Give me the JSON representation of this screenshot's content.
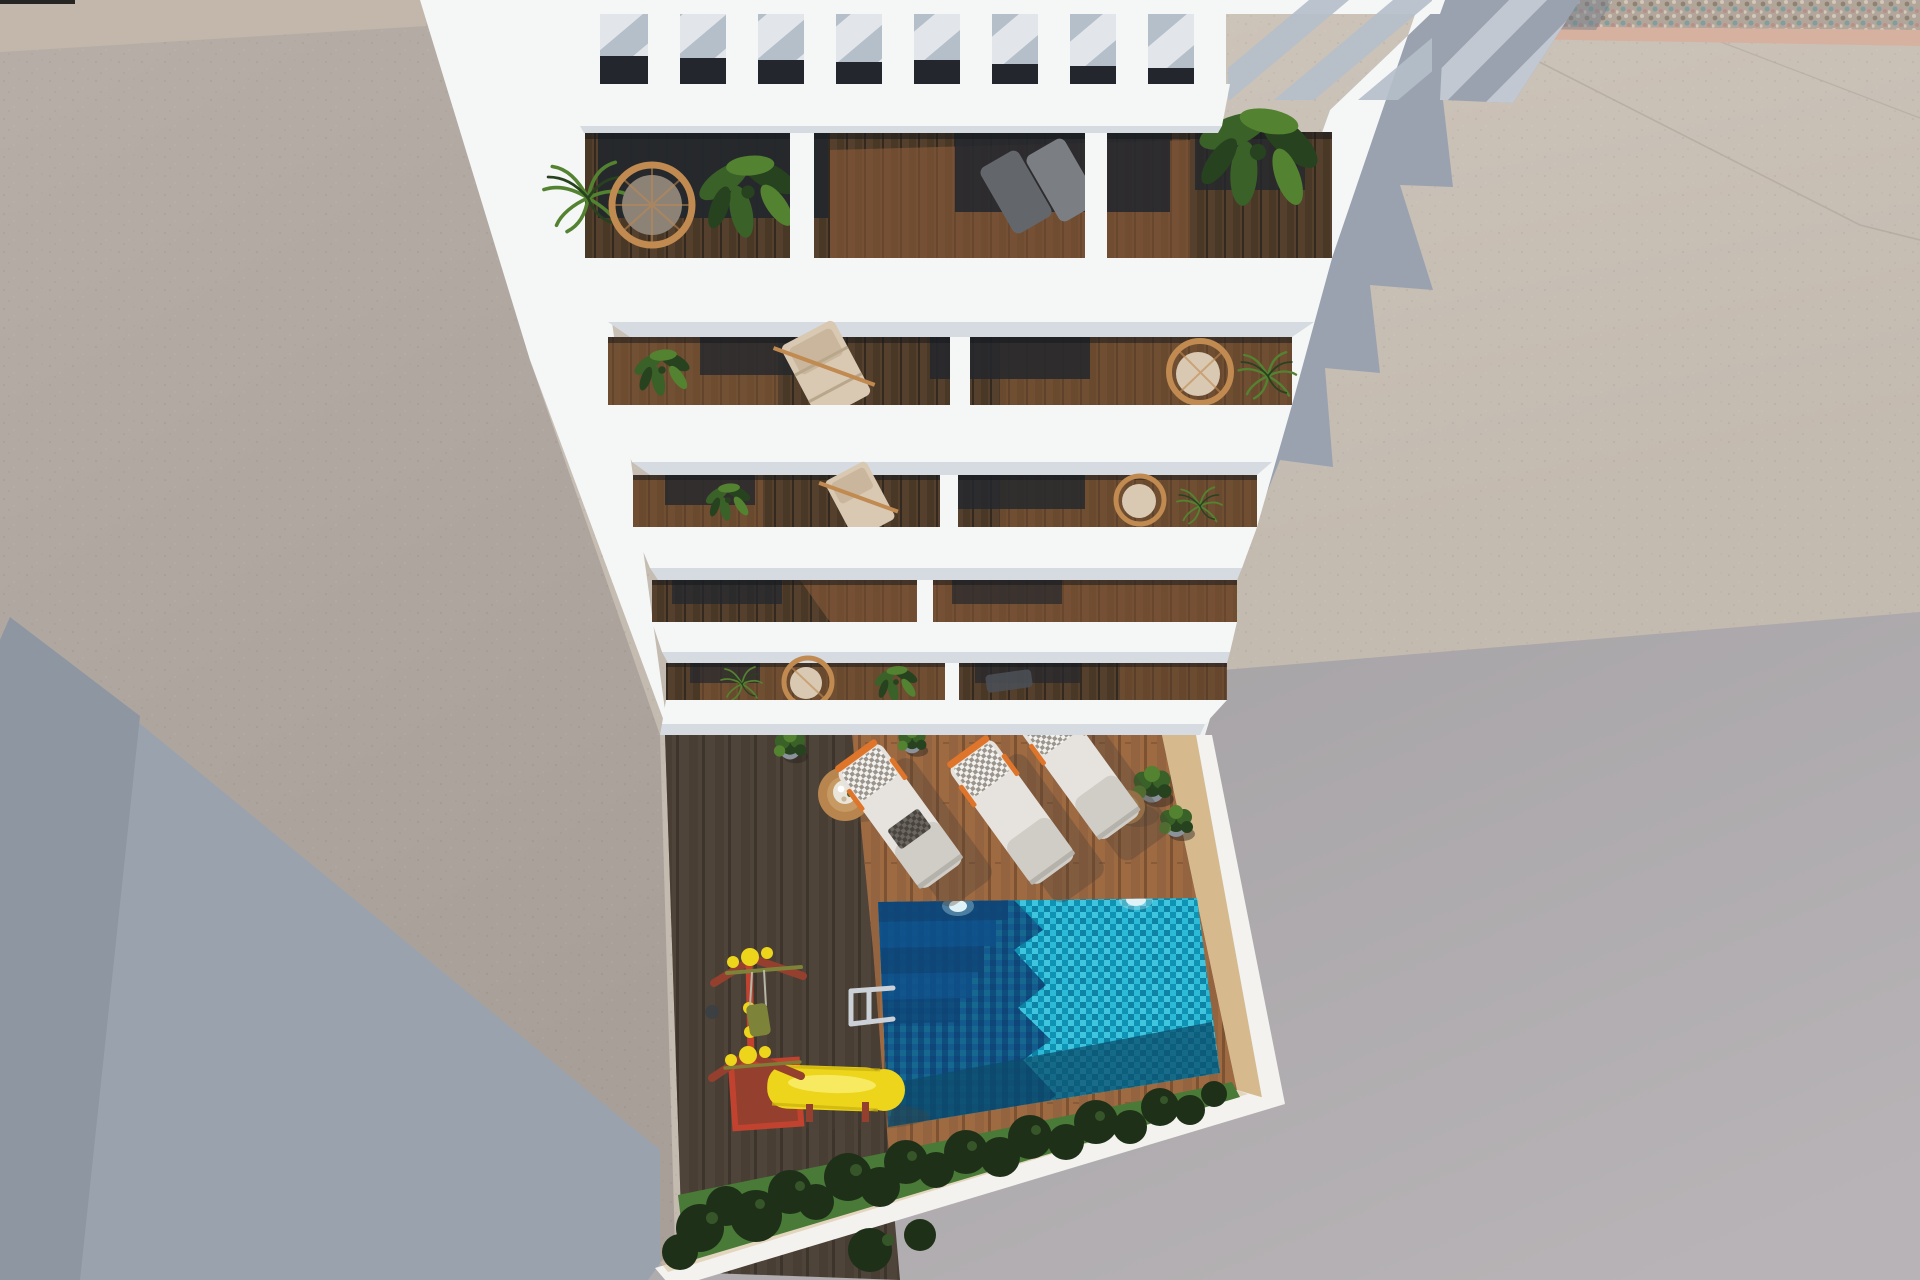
{
  "canvas": {
    "width": 1920,
    "height": 1280
  },
  "scene": {
    "description": "aerial-3d-render-of-white-apartment-building-with-balconies-pool-courtyard",
    "building": {
      "floors": 5,
      "pergola": {
        "slats": 8,
        "openings": 8
      },
      "balcony_furniture": "wicker chairs, deck chairs, loungers, palms and banana plants"
    },
    "courtyard": {
      "sun_loungers": 3,
      "side_tables": 2,
      "potted_plants": 5,
      "pool": {
        "shape": "rectangular",
        "corner_steps": true,
        "ladder": true,
        "lights": 2
      },
      "playground": {
        "swing_set": 1,
        "slide": 1
      },
      "hedge_row": true,
      "lawn_strip": true
    },
    "lighting": {
      "sun_direction": "upper-left",
      "shadows_cast": "lower-right"
    }
  },
  "colors": {
    "white": "#f5f6f6",
    "white_dim": "#e9ecee",
    "slab_edge": "#d6dbe1",
    "slab_tint": "#eef0f2",
    "window_dark": "#23272d",
    "stripe_shadow": "#b5bfca",
    "gap_light": "#e2e6ea",
    "wall_left": "#b7afa7",
    "wall_left_deep": "#a8a098",
    "beige_strip": "#c2b7aa",
    "corner_shadow": "#9aa2ad",
    "corner_shadow_deep": "#8e96a2",
    "ground_sun": "#c3bab0",
    "ground_sun_light": "#cfc6bc",
    "ground_shade": "#a3a0a3",
    "ground_shade_light": "#b7b3b6",
    "cast_shadow": "#9aa2b0",
    "cast_stripe": "#c6ccd6",
    "gravel": "#b2a599",
    "gravel_dot1": "#8e8275",
    "gravel_dot2": "#d2c8bb",
    "gravel_dot3": "#7f9e9e",
    "gravel_dot4": "#bb8f88",
    "curb": "#d7b19f",
    "wood_sun": "#9d6a42",
    "wood_sun_dark": "#7d5232",
    "wood_sun_alt": "#946340",
    "wood_shade": "#4f443a",
    "wood_shade_dark": "#3d342c",
    "balcony_wood": "#55402d",
    "balcony_wood_dark": "#34291f",
    "balcony_wood_lit": "#8a5c38",
    "tan_wall": "#d6ba8e",
    "band_white": "#f3f2ef",
    "pool_b1": "#3fc6de",
    "pool_b2": "#0f93b4",
    "pool_b3": "#0d84a6",
    "pool_b4": "#2dbad6",
    "pool_d1": "#135a8e",
    "pool_d2": "#0f4577",
    "pool_d3": "#16688f",
    "pool_d4": "#0e4e7e",
    "pool_steps": "#0f4577",
    "pool_depth": "#0d4b69",
    "plant_dark": "#27421f",
    "plant_mid": "#3a6127",
    "plant_light": "#538230",
    "rattan": "#c08a50",
    "cushion": "#d9c9b3",
    "cushion_gray": "#8d8276",
    "dark_chair": "#565b60",
    "lounger": "#e6e3de",
    "lounger_shade": "#bdb9b3",
    "checker_bg": "#f2f1ed",
    "checker_fg": "#9b958d",
    "checker_dbg": "#6b665f",
    "checker_dfg": "#48443e",
    "orange": "#df752a",
    "table_wood": "#b8854e",
    "table_inner": "#c79a63",
    "maroon": "#953f2e",
    "red": "#c24230",
    "yellow": "#ecd51b",
    "yellow_deep": "#cdb40f",
    "yellow_hi": "#f7ea60",
    "olive": "#7d8338",
    "grass": "#4a7a38",
    "bush": "#1e3018",
    "bush_leaf": "#36562a",
    "chrome": "#ccd1d7",
    "shadow_soft": "#4c4136"
  }
}
